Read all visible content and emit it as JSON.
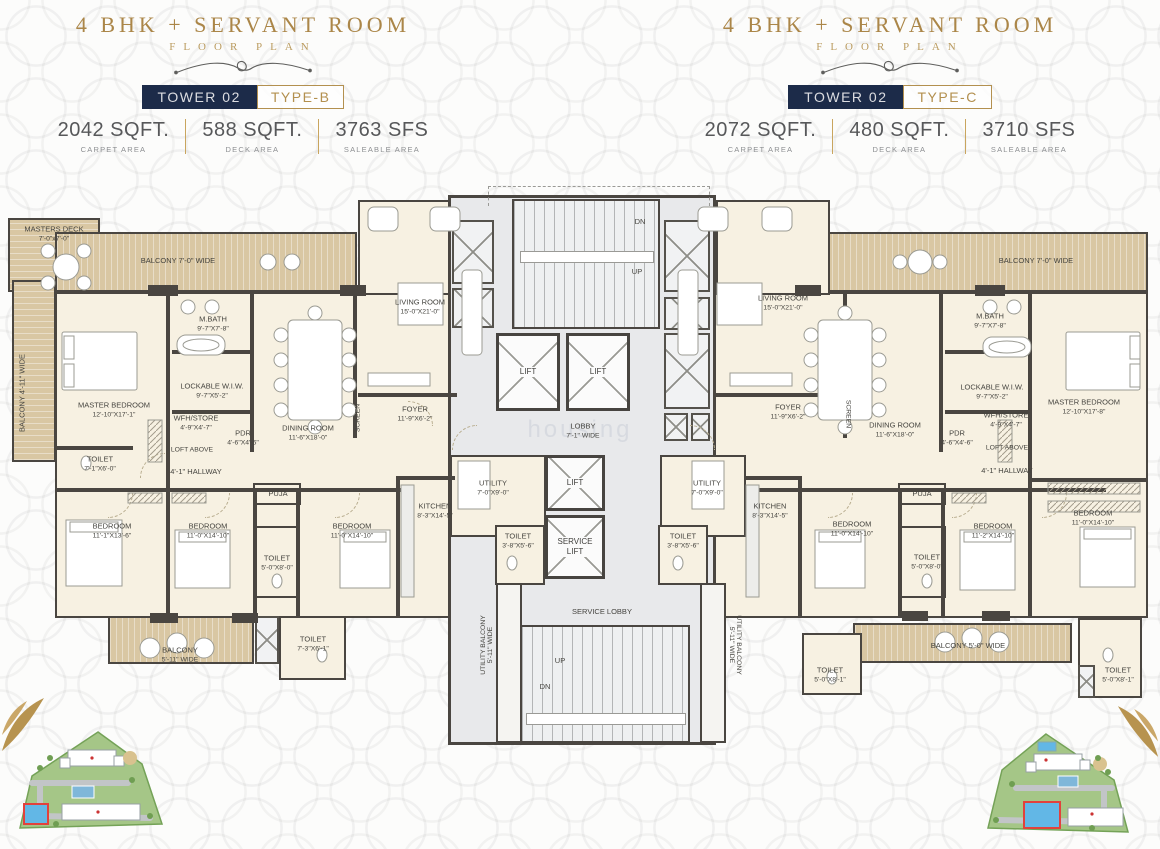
{
  "watermark": "housing",
  "colors": {
    "accent_gold": "#b3904f",
    "navy": "#1c2b49",
    "wall": "#4a4641",
    "room_cream": "#f7f1e2",
    "balcony_wood": "#d9c7a3",
    "core_gray": "#e8e9eb"
  },
  "header_b": {
    "title": "4 BHK + SERVANT ROOM",
    "subtitle": "FLOOR PLAN",
    "tower": "TOWER 02",
    "type": "TYPE-B",
    "stats": [
      {
        "value": "2042 SQFT.",
        "label": "CARPET AREA"
      },
      {
        "value": "588 SQFT.",
        "label": "DECK AREA"
      },
      {
        "value": "3763 SFS",
        "label": "SALEABLE AREA"
      }
    ]
  },
  "header_c": {
    "title": "4 BHK + SERVANT ROOM",
    "subtitle": "FLOOR PLAN",
    "tower": "TOWER 02",
    "type": "TYPE-C",
    "stats": [
      {
        "value": "2072 SQFT.",
        "label": "CARPET AREA"
      },
      {
        "value": "480 SQFT.",
        "label": "DECK AREA"
      },
      {
        "value": "3710 SFS",
        "label": "SALEABLE AREA"
      }
    ]
  },
  "core": {
    "dn": "DN",
    "up": "UP",
    "lift": "LIFT",
    "service_lift": "SERVICE LIFT",
    "lobby": {
      "name": "LOBBY",
      "dims": "7'-1\" WIDE"
    },
    "service_lobby": "SERVICE LOBBY",
    "utility": {
      "name": "UTILITY",
      "dims": "7'-0\"X9'-0\""
    },
    "utility_toilet": {
      "name": "TOILET",
      "dims": "3'-8\"X5'-6\""
    },
    "utility_balcony": {
      "name": "UTILITY BALCONY",
      "dims": "5'-11\" WIDE"
    }
  },
  "unit_b": {
    "masters_deck": {
      "name": "MASTERS DECK",
      "dims": "7'-0\"x7'-0\""
    },
    "balcony_top": {
      "name": "BALCONY 7'-0\" WIDE"
    },
    "balcony_side": {
      "name": "BALCONY 4'-11\" WIDE"
    },
    "master_bedroom": {
      "name": "MASTER BEDROOM",
      "dims": "12'-10\"X17'-1\""
    },
    "m_bath": {
      "name": "M.BATH",
      "dims": "9'-7\"X7'-8\""
    },
    "wiw": {
      "name": "LOCKABLE W.I.W.",
      "dims": "9'-7\"X5'-2\""
    },
    "wfh": {
      "name": "WFH/STORE",
      "dims": "4'-9\"X4'-7\""
    },
    "loft": "LOFT ABOVE",
    "pdr": {
      "name": "PDR",
      "dims": "4'-6\"X4'-6\""
    },
    "toilet_master": {
      "name": "TOILET",
      "dims": "7'-1\"X6'-0\""
    },
    "hallway": "4'-1\" HALLWAY",
    "living": {
      "name": "LIVING ROOM",
      "dims": "15'-0\"X21'-0\""
    },
    "dining": {
      "name": "DINING ROOM",
      "dims": "11'-6\"X18'-0\""
    },
    "screen": "SCREEN",
    "foyer": {
      "name": "FOYER",
      "dims": "11'-9\"X6'-2\""
    },
    "puja": "PUJA",
    "bedroom2": {
      "name": "BEDROOM",
      "dims": "11'-1\"X13'-6\""
    },
    "bedroom3": {
      "name": "BEDROOM",
      "dims": "11'-0\"X14'-10\""
    },
    "toilet_mid": {
      "name": "TOILET",
      "dims": "5'-0\"X8'-0\""
    },
    "bedroom4": {
      "name": "BEDROOM",
      "dims": "11'-0\"X14'-10\""
    },
    "kitchen": {
      "name": "KITCHEN",
      "dims": "8'-3\"X14'-5\""
    },
    "balcony_bottom": {
      "name": "BALCONY",
      "dims": "5'-11\" WIDE"
    },
    "toilet_bottom": {
      "name": "TOILET",
      "dims": "7'-3\"X6'-1\""
    }
  },
  "unit_c": {
    "balcony_top": {
      "name": "BALCONY 7'-0\" WIDE"
    },
    "master_bedroom": {
      "name": "MASTER BEDROOM",
      "dims": "12'-10\"X17'-8\""
    },
    "m_bath": {
      "name": "M.BATH",
      "dims": "9'-7\"X7'-8\""
    },
    "wiw": {
      "name": "LOCKABLE W.I.W.",
      "dims": "9'-7\"X5'-2\""
    },
    "wfh": {
      "name": "WFH/STORE",
      "dims": "4'-9\"X4'-7\""
    },
    "loft": "LOFT ABOVE",
    "pdr": {
      "name": "PDR",
      "dims": "4'-6\"X4'-6\""
    },
    "hallway": "4'-1\" HALLWAY",
    "living": {
      "name": "LIVING ROOM",
      "dims": "15'-0\"X21'-0\""
    },
    "dining": {
      "name": "DINING ROOM",
      "dims": "11'-6\"X18'-0\""
    },
    "screen": "SCREEN",
    "foyer": {
      "name": "FOYER",
      "dims": "11'-9\"X6'-2\""
    },
    "puja": "PUJA",
    "kitchen": {
      "name": "KITCHEN",
      "dims": "8'-3\"X14'-5\""
    },
    "bedroom2": {
      "name": "BEDROOM",
      "dims": "11'-0\"X14'-10\""
    },
    "toilet_mid": {
      "name": "TOILET",
      "dims": "5'-0\"X8'-0\""
    },
    "bedroom3": {
      "name": "BEDROOM",
      "dims": "11'-2\"X14'-10\""
    },
    "bedroom4": {
      "name": "BEDROOM",
      "dims": "11'-0\"X14'-10\""
    },
    "balcony_bottom": {
      "name": "BALCONY 5'-0\" WIDE"
    },
    "toilet_b1": {
      "name": "TOILET",
      "dims": "5'-0\"X8'-1\""
    },
    "toilet_b2": {
      "name": "TOILET",
      "dims": "5'-0\"X8'-1\""
    }
  }
}
